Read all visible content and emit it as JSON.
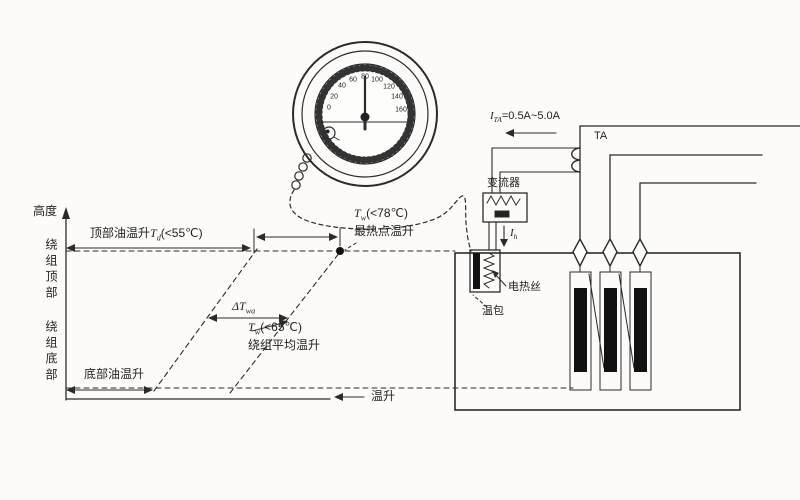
{
  "chart": {
    "y_axis_label": "高度",
    "x_axis_label": "温升",
    "winding_top_label": "绕组顶部",
    "winding_bottom_label": "绕组底部",
    "top_oil": {
      "label": "顶部油温升",
      "var": "T",
      "sub": "d",
      "cond": "(<55℃)"
    },
    "hotspot": {
      "var": "T",
      "sub": "w",
      "cond": "(<78℃)",
      "name": "最热点温升"
    },
    "delta": {
      "var": "ΔT",
      "sub": "wa"
    },
    "avg": {
      "var": "T",
      "sub": "w",
      "cond": "(<65℃)",
      "name": "绕组平均温升"
    },
    "bottom_oil_label": "底部油温升"
  },
  "gauge": {
    "scale_labels": [
      "0",
      "20",
      "40",
      "60",
      "80",
      "100",
      "120",
      "140",
      "160"
    ]
  },
  "circuit": {
    "ta_current": {
      "var": "I",
      "sub": "TA",
      "value": "=0.5A~5.0A"
    },
    "ta_label": "TA",
    "converter_label": "变流器",
    "heater_current": {
      "var": "I",
      "sub": "h"
    },
    "heater_label": "电热丝",
    "bulb_label": "温包"
  },
  "colors": {
    "ink": "#2b2b2b",
    "bar": "#111111"
  }
}
